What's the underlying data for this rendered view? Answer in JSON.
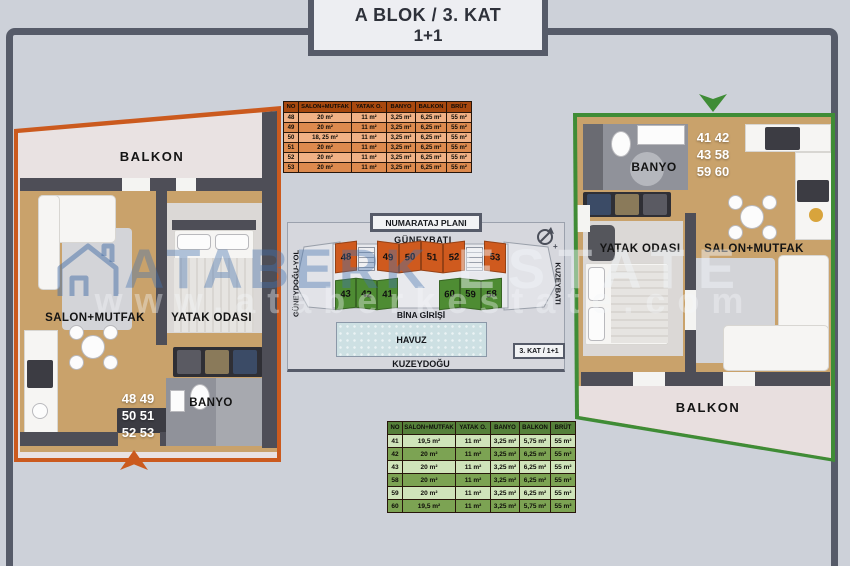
{
  "title": {
    "line1": "A BLOK / 3. KAT",
    "line2": "1+1"
  },
  "watermark": {
    "brand_left": "ATABERK",
    "brand_right": "ESTATE",
    "url": "www.ataberkestate.com"
  },
  "left_plan": {
    "balcony_label": "BALKON",
    "salon_label": "SALON+MUTFAK",
    "bedroom_label": "YATAK ODASI",
    "bath_label": "BANYO",
    "unit_lines": "48  49\n50  51\n52  53"
  },
  "right_plan": {
    "balcony_label": "BALKON",
    "salon_label": "SALON+MUTFAK",
    "bedroom_label": "YATAK ODASI",
    "bath_label": "BANYO",
    "unit_lines": "41  42\n43  58\n59  60"
  },
  "orange_table": {
    "headers": [
      "NO",
      "SALON+MUTFAK",
      "YATAK O.",
      "BANYO",
      "BALKON",
      "BRÜT"
    ],
    "rows": [
      [
        "48",
        "20 m²",
        "11 m²",
        "3,25 m²",
        "6,25 m²",
        "55 m²"
      ],
      [
        "49",
        "20 m²",
        "11 m²",
        "3,25 m²",
        "6,25 m²",
        "55 m²"
      ],
      [
        "50",
        "18, 25 m²",
        "11 m²",
        "3,25 m²",
        "6,25 m²",
        "55 m²"
      ],
      [
        "51",
        "20 m²",
        "11 m²",
        "3,25 m²",
        "6,25 m²",
        "55 m²"
      ],
      [
        "52",
        "20 m²",
        "11 m²",
        "3,25 m²",
        "6,25 m²",
        "55 m²"
      ],
      [
        "53",
        "20 m²",
        "11 m²",
        "3,25 m²",
        "6,25 m²",
        "55 m²"
      ]
    ]
  },
  "green_table": {
    "headers": [
      "NO",
      "SALON+MUTFAK",
      "YATAK O.",
      "BANYO",
      "BALKON",
      "BRÜT"
    ],
    "rows": [
      [
        "41",
        "19,5 m²",
        "11 m²",
        "3,25 m²",
        "5,75 m²",
        "55 m²"
      ],
      [
        "42",
        "20 m²",
        "11 m²",
        "3,25 m²",
        "6,25 m²",
        "55 m²"
      ],
      [
        "43",
        "20 m²",
        "11 m²",
        "3,25 m²",
        "6,25 m²",
        "55 m²"
      ],
      [
        "58",
        "20 m²",
        "11 m²",
        "3,25 m²",
        "6,25 m²",
        "55 m²"
      ],
      [
        "59",
        "20 m²",
        "11 m²",
        "3,25 m²",
        "6,25 m²",
        "55 m²"
      ],
      [
        "60",
        "19,5 m²",
        "11 m²",
        "3,25 m²",
        "5,75 m²",
        "55 m²"
      ]
    ]
  },
  "site_plan": {
    "title": "NUMARATAJ PLANI",
    "top_label": "GÜNEYBATI",
    "left_label": "GÜNEYDOĞU-YOL",
    "right_label": "KUZEYBATI",
    "entrance_label": "BİNA GİRİŞİ",
    "pool_label": "HAVUZ",
    "bottom_label": "KUZEYDOĞU",
    "floor_badge": "3. KAT / 1+1",
    "orange_units": [
      "48",
      "49",
      "50",
      "51",
      "52",
      "53"
    ],
    "green_units_left": [
      "43",
      "42",
      "41"
    ],
    "green_units_right": [
      "60",
      "59",
      "58"
    ]
  },
  "colors": {
    "accent_orange": "#cb5a1e",
    "accent_green": "#3f8c36",
    "frame": "#565b69",
    "background": "#cdd1d9",
    "wood_floor": "#c9a26b",
    "pool": "#cde0e3"
  }
}
